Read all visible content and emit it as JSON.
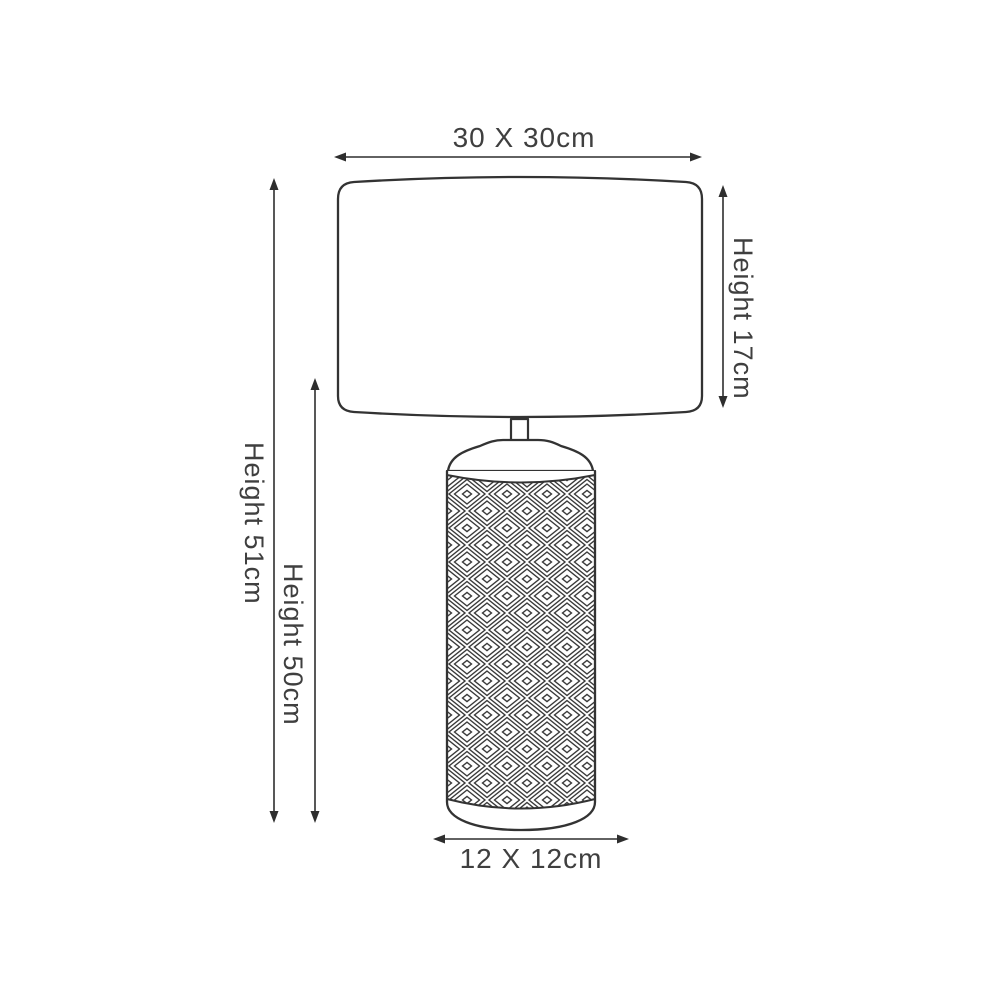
{
  "diagram": {
    "kind": "product-dimension-diagram",
    "subject": "Table lamp with drum shade and diamond-patterned cylindrical base",
    "colors": {
      "line": "#333333",
      "text": "#3f3f3f",
      "background": "#ffffff"
    },
    "labels": {
      "shade_width": "30 X 30cm",
      "shade_height": "Height 17cm",
      "total_height": "Height 51cm",
      "base_height": "Height 50cm",
      "base_width": "12 X 12cm"
    }
  }
}
